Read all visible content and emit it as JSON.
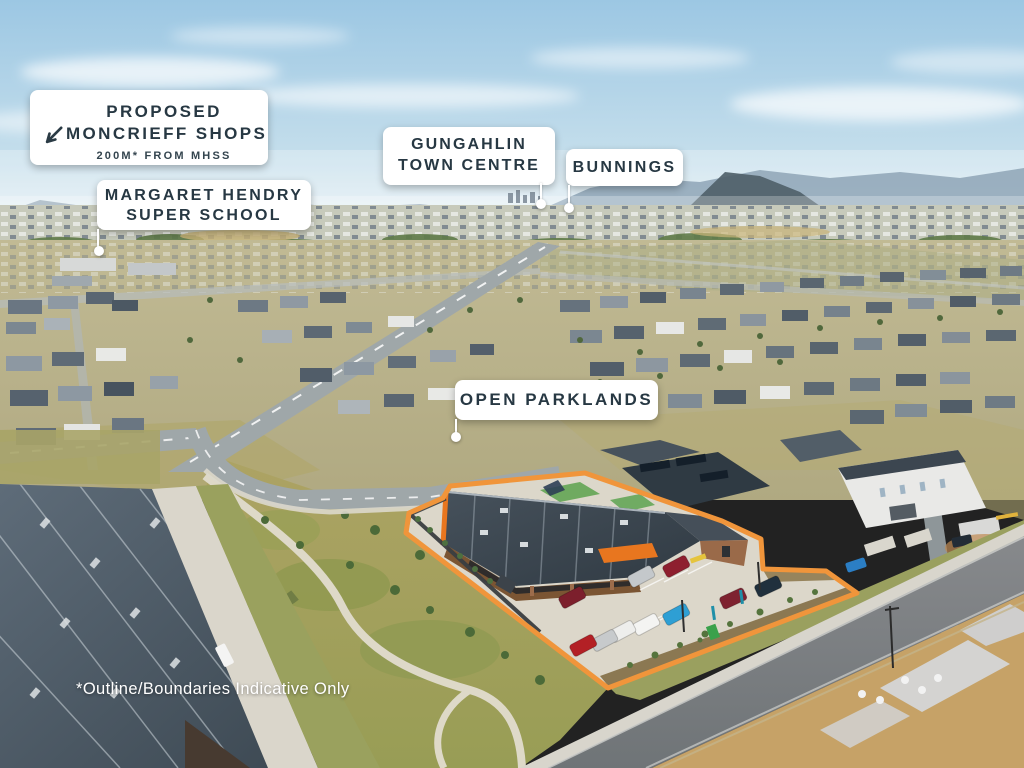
{
  "annotations": {
    "proposed_shops": {
      "line1": "PROPOSED",
      "line2": "MONCRIEFF SHOPS",
      "subline": "200M* FROM MHSS"
    },
    "school": {
      "line1": "MARGARET HENDRY",
      "line2": "SUPER SCHOOL"
    },
    "town_centre": {
      "line1": "GUNGAHLIN",
      "line2": "TOWN CENTRE"
    },
    "bunnings": {
      "line1": "BUNNINGS"
    },
    "parklands": {
      "line1": "OPEN PARKLANDS"
    }
  },
  "disclaimer": "*Outline/Boundaries Indicative Only",
  "style": {
    "label_bg": "#ffffff",
    "label_text": "#273843",
    "outline_color": "#f0953b",
    "leader_color": "#ffffff",
    "building_accent": "#e8761f"
  }
}
